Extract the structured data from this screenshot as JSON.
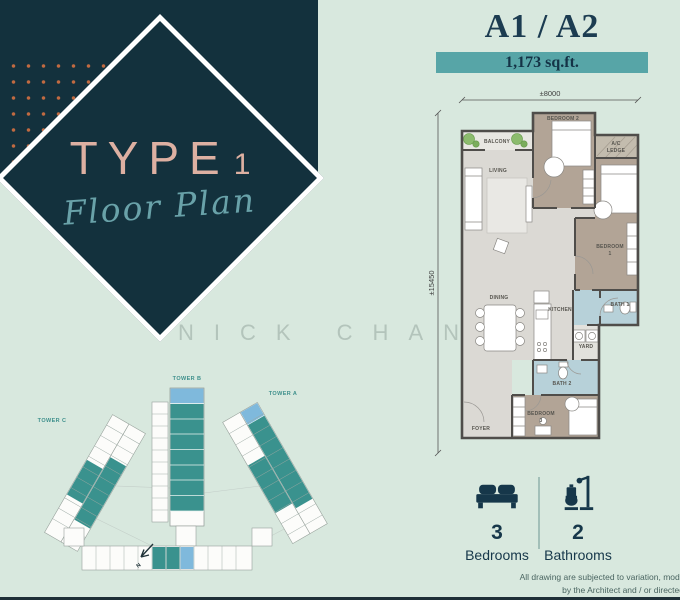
{
  "brand": {
    "type_word": "TYPE",
    "type_number": "1",
    "script": "Floor Plan"
  },
  "header": {
    "unit_title": "A1 / A2",
    "area": "1,173 sq.ft."
  },
  "dimensions": {
    "width": "±8000",
    "height": "±15450"
  },
  "rooms": {
    "balcony": "BALCONY",
    "living": "LIVING",
    "bedroom2": "BEDROOM 2",
    "ac_line1": "A/C",
    "ac_line2": "LEDGE",
    "bedroom1_line1": "BEDROOM",
    "bedroom1_line2": "1",
    "dining": "DINING",
    "kitchen": "KITCHEN",
    "bath1": "BATH 1",
    "yard": "YARD",
    "bath2": "BATH 2",
    "bedroom3_line1": "BEDROOM",
    "bedroom3_line2": "3",
    "foyer": "FOYER"
  },
  "siteplan": {
    "tower_c": "TOWER C",
    "tower_b": "TOWER B",
    "tower_a": "TOWER A",
    "north": "N"
  },
  "stats": {
    "bedrooms": {
      "value": "3",
      "label": "Bedrooms"
    },
    "bathrooms": {
      "value": "2",
      "label": "Bathrooms"
    }
  },
  "watermark": "NICK CHAN",
  "disclaimer": {
    "line1": "All drawing are subjected to variation, modif",
    "line2": "by the Architect and / or directed"
  },
  "colors": {
    "dark_teal": "#13313d",
    "mint": "#d8e8de",
    "accent_teal": "#57a5a7",
    "navy": "#16374a",
    "rose": "#ddb0a2",
    "script_teal": "#69a2a9",
    "highlight_teal": "#3a928e",
    "highlight_blue": "#7fb9dc",
    "dot_orange": "#c06a41"
  }
}
